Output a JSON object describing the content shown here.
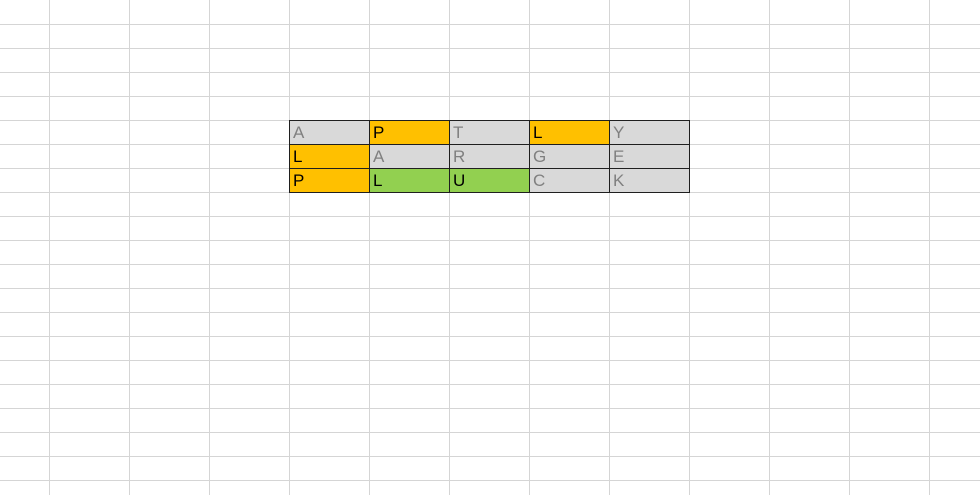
{
  "sheet": {
    "background_color": "#ffffff",
    "gridline_color": "#d5d5d5",
    "first_column_width_px": 49,
    "column_width_px": 80,
    "row_height_px": 24
  },
  "puzzle_grid": {
    "location": {
      "left_px": 289,
      "top_px": 120,
      "cell_width_px": 80,
      "cell_height_px": 24
    },
    "border_color": "#1f1f1f",
    "state_colors": {
      "absent": {
        "fill": "#d9d9d9",
        "text": "#808080"
      },
      "present": {
        "fill": "#ffc000",
        "text": "#000000"
      },
      "correct": {
        "fill": "#92d050",
        "text": "#000000"
      }
    },
    "guesses": [
      {
        "word": "APTLY",
        "cells": [
          {
            "letter": "A",
            "state": "absent"
          },
          {
            "letter": "P",
            "state": "present"
          },
          {
            "letter": "T",
            "state": "absent"
          },
          {
            "letter": "L",
            "state": "present"
          },
          {
            "letter": "Y",
            "state": "absent"
          }
        ]
      },
      {
        "word": "LARGE",
        "cells": [
          {
            "letter": "L",
            "state": "present"
          },
          {
            "letter": "A",
            "state": "absent"
          },
          {
            "letter": "R",
            "state": "absent"
          },
          {
            "letter": "G",
            "state": "absent"
          },
          {
            "letter": "E",
            "state": "absent"
          }
        ]
      },
      {
        "word": "PLUCK",
        "cells": [
          {
            "letter": "P",
            "state": "present"
          },
          {
            "letter": "L",
            "state": "correct"
          },
          {
            "letter": "U",
            "state": "correct"
          },
          {
            "letter": "C",
            "state": "absent"
          },
          {
            "letter": "K",
            "state": "absent"
          }
        ]
      }
    ]
  }
}
